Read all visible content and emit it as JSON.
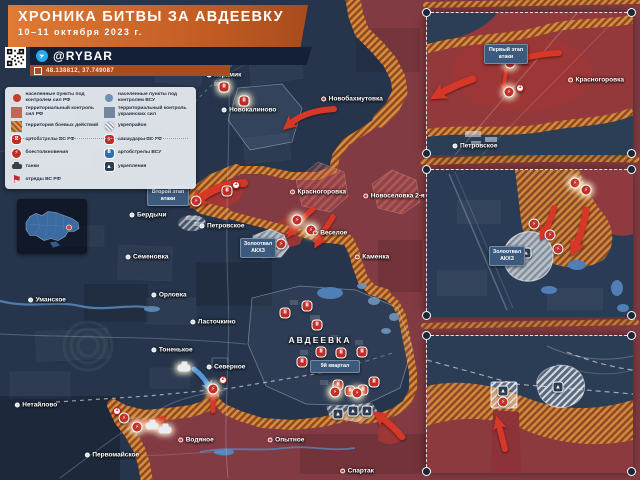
{
  "header": {
    "title": "ХРОНИКА БИТВЫ ЗА АВДЕЕВКУ",
    "date": "10–11 октября 2023 г."
  },
  "brand": {
    "handle": "@RYBAR",
    "coordinates": "48.138812, 37.749087",
    "telegram_icon": "➤"
  },
  "colors": {
    "header_orange": "#d3641f",
    "bar_navy": "#121e36",
    "map_navy": "#26354c",
    "map_red": "#833b43",
    "battle_orange": "#d98a3c",
    "accent_red": "#c03026",
    "accent_blue": "#2e6fae"
  },
  "legend": {
    "left": [
      {
        "type": "dot-rf",
        "glyph": "",
        "label": "населенные пункты под контролем сил РФ"
      },
      {
        "type": "hex-rf",
        "glyph": "",
        "label": "территориальный контроль сил РФ"
      },
      {
        "type": "hex-battle",
        "glyph": "",
        "label": "территория боевых действий"
      },
      {
        "type": "shell-rf",
        "glyph": "Ⅱ",
        "label": "артобстрелы ВС РФ"
      },
      {
        "type": "clash",
        "glyph": "⚡",
        "label": "боестолкновения"
      },
      {
        "type": "tank",
        "glyph": "",
        "label": "танки"
      },
      {
        "type": "flag-rf",
        "glyph": "⚑",
        "label": "отряды ВС РФ"
      }
    ],
    "right": [
      {
        "type": "dot-ua",
        "glyph": "",
        "label": "населенные пункты под контролем ВСУ"
      },
      {
        "type": "hex-ua",
        "glyph": "",
        "label": "территориальный контроль украинских сил"
      },
      {
        "type": "hex-fortarea",
        "glyph": "",
        "label": "укрепрайон"
      },
      {
        "type": "air-rf",
        "glyph": "✈",
        "label": "авиаудары ВС РФ"
      },
      {
        "type": "shell-ua",
        "glyph": "Ⅱ",
        "label": "артобстрелы ВСУ"
      },
      {
        "type": "fort",
        "glyph": "▲",
        "label": "укрепления"
      }
    ]
  },
  "map": {
    "towns": [
      {
        "label": "Керамик",
        "x": 224,
        "y": 75,
        "control": "ua",
        "size": ""
      },
      {
        "label": "Новокалиново",
        "x": 249,
        "y": 110,
        "control": "ua",
        "size": ""
      },
      {
        "label": "Новобахмутовка",
        "x": 352,
        "y": 99,
        "control": "rf",
        "size": ""
      },
      {
        "label": "Красногоровка",
        "x": 318,
        "y": 192,
        "control": "rf",
        "size": ""
      },
      {
        "label": "Новоселовка 2-я",
        "x": 394,
        "y": 196,
        "control": "rf",
        "size": ""
      },
      {
        "label": "Бердычи",
        "x": 148,
        "y": 215,
        "control": "ua",
        "size": ""
      },
      {
        "label": "Петровское",
        "x": 222,
        "y": 226,
        "control": "ua",
        "size": ""
      },
      {
        "label": "Веселое",
        "x": 330,
        "y": 233,
        "control": "rf",
        "size": ""
      },
      {
        "label": "Каменка",
        "x": 372,
        "y": 257,
        "control": "rf",
        "size": ""
      },
      {
        "label": "Семеновка",
        "x": 147,
        "y": 257,
        "control": "ua",
        "size": ""
      },
      {
        "label": "Орловка",
        "x": 169,
        "y": 295,
        "control": "ua",
        "size": ""
      },
      {
        "label": "Ласточкино",
        "x": 213,
        "y": 322,
        "control": "ua",
        "size": ""
      },
      {
        "label": "Уманское",
        "x": 47,
        "y": 300,
        "control": "ua",
        "size": ""
      },
      {
        "label": "Тоненькое",
        "x": 172,
        "y": 350,
        "control": "ua",
        "size": ""
      },
      {
        "label": "Северное",
        "x": 226,
        "y": 367,
        "control": "ua",
        "size": ""
      },
      {
        "label": "АВДЕЕВКА",
        "x": 320,
        "y": 340,
        "control": "ua",
        "size": "big"
      },
      {
        "label": "Нетайлово",
        "x": 36,
        "y": 405,
        "control": "ua",
        "size": ""
      },
      {
        "label": "Водяное",
        "x": 196,
        "y": 440,
        "control": "rf",
        "size": ""
      },
      {
        "label": "Опытное",
        "x": 286,
        "y": 440,
        "control": "rf",
        "size": ""
      },
      {
        "label": "Первомайское",
        "x": 112,
        "y": 455,
        "control": "ua",
        "size": ""
      },
      {
        "label": "Спартак",
        "x": 357,
        "y": 471,
        "control": "rf",
        "size": ""
      },
      {
        "label": "Красногоровка",
        "x": 596,
        "y": 80,
        "control": "rf",
        "size": ""
      },
      {
        "label": "Петровское",
        "x": 475,
        "y": 146,
        "control": "ua",
        "size": ""
      }
    ],
    "badges": [
      {
        "label": "Второй этап атаки",
        "x": 147,
        "y": 186,
        "w": 36
      },
      {
        "label": "Золоотвал АКХЗ",
        "x": 240,
        "y": 238,
        "w": 30
      },
      {
        "label": "9й квартал",
        "x": 310,
        "y": 360,
        "w": 44
      },
      {
        "label": "Первый этап атаки",
        "x": 484,
        "y": 44,
        "w": 38
      },
      {
        "label": "Золоотвал АКХЗ",
        "x": 489,
        "y": 246,
        "w": 30
      }
    ],
    "icons": [
      {
        "name": "shelling-icon",
        "type": "shell-rf",
        "glyph": "Ⅱ",
        "x": 224,
        "y": 87,
        "fx": "glow"
      },
      {
        "name": "shelling-icon",
        "type": "shell-rf",
        "glyph": "Ⅱ",
        "x": 244,
        "y": 101,
        "fx": "glow"
      },
      {
        "name": "clash-icon",
        "type": "clash",
        "glyph": "⚡",
        "x": 196,
        "y": 201,
        "fx": ""
      },
      {
        "name": "number-marker",
        "type": "num",
        "glyph": "1",
        "x": 236,
        "y": 185,
        "fx": ""
      },
      {
        "name": "shelling-icon",
        "type": "shell-rf",
        "glyph": "Ⅱ",
        "x": 227,
        "y": 191,
        "fx": ""
      },
      {
        "name": "clash-icon",
        "type": "clash",
        "glyph": "⚡",
        "x": 297,
        "y": 220,
        "fx": "glow"
      },
      {
        "name": "clash-icon",
        "type": "clash",
        "glyph": "⚡",
        "x": 311,
        "y": 230,
        "fx": "glow"
      },
      {
        "name": "fortification-icon",
        "type": "fort",
        "glyph": "▲",
        "x": 258,
        "y": 247,
        "fx": ""
      },
      {
        "name": "clash-icon",
        "type": "clash",
        "glyph": "⚡",
        "x": 281,
        "y": 244,
        "fx": ""
      },
      {
        "name": "shelling-icon",
        "type": "shell-rf",
        "glyph": "Ⅱ",
        "x": 285,
        "y": 313,
        "fx": ""
      },
      {
        "name": "shelling-icon",
        "type": "shell-rf",
        "glyph": "Ⅱ",
        "x": 307,
        "y": 306,
        "fx": ""
      },
      {
        "name": "shelling-icon",
        "type": "shell-rf",
        "glyph": "Ⅱ",
        "x": 317,
        "y": 325,
        "fx": ""
      },
      {
        "name": "shelling-icon",
        "type": "shell-rf",
        "glyph": "Ⅱ",
        "x": 302,
        "y": 362,
        "fx": ""
      },
      {
        "name": "shelling-icon",
        "type": "shell-rf",
        "glyph": "Ⅱ",
        "x": 321,
        "y": 352,
        "fx": ""
      },
      {
        "name": "shelling-icon",
        "type": "shell-rf",
        "glyph": "Ⅱ",
        "x": 341,
        "y": 353,
        "fx": ""
      },
      {
        "name": "shelling-icon",
        "type": "shell-rf",
        "glyph": "Ⅱ",
        "x": 362,
        "y": 352,
        "fx": ""
      },
      {
        "name": "shelling-icon",
        "type": "shell-rf",
        "glyph": "Ⅱ",
        "x": 338,
        "y": 385,
        "fx": ""
      },
      {
        "name": "shelling-icon",
        "type": "shell-rf",
        "glyph": "Ⅱ",
        "x": 350,
        "y": 391,
        "fx": ""
      },
      {
        "name": "shelling-icon",
        "type": "shell-rf",
        "glyph": "Ⅱ",
        "x": 363,
        "y": 390,
        "fx": ""
      },
      {
        "name": "shelling-icon",
        "type": "shell-rf",
        "glyph": "Ⅱ",
        "x": 374,
        "y": 382,
        "fx": ""
      },
      {
        "name": "fortification-icon",
        "type": "fort",
        "glyph": "▲",
        "x": 338,
        "y": 414,
        "fx": ""
      },
      {
        "name": "fortification-icon",
        "type": "fort",
        "glyph": "▲",
        "x": 353,
        "y": 411,
        "fx": ""
      },
      {
        "name": "fortification-icon",
        "type": "fort",
        "glyph": "▲",
        "x": 367,
        "y": 411,
        "fx": ""
      },
      {
        "name": "tank-icon",
        "type": "tank",
        "glyph": "",
        "x": 184,
        "y": 368,
        "fx": "glow"
      },
      {
        "name": "number-marker",
        "type": "num",
        "glyph": "2",
        "x": 223,
        "y": 380,
        "fx": ""
      },
      {
        "name": "clash-icon",
        "type": "clash",
        "glyph": "⚡",
        "x": 213,
        "y": 389,
        "fx": "glow"
      },
      {
        "name": "number-marker",
        "type": "num",
        "glyph": "1",
        "x": 117,
        "y": 411,
        "fx": ""
      },
      {
        "name": "clash-icon",
        "type": "clash",
        "glyph": "⚡",
        "x": 124,
        "y": 418,
        "fx": ""
      },
      {
        "name": "clash-icon",
        "type": "clash",
        "glyph": "⚡",
        "x": 137,
        "y": 427,
        "fx": "glow"
      },
      {
        "name": "tank-icon",
        "type": "tank",
        "glyph": "",
        "x": 152,
        "y": 426,
        "fx": "glow"
      },
      {
        "name": "tank-icon",
        "type": "tank",
        "glyph": "",
        "x": 165,
        "y": 430,
        "fx": "glow"
      },
      {
        "name": "clash-icon",
        "type": "clash",
        "glyph": "⚡",
        "x": 335,
        "y": 392,
        "fx": "glow"
      },
      {
        "name": "clash-icon",
        "type": "clash",
        "glyph": "⚡",
        "x": 357,
        "y": 393,
        "fx": "glow"
      },
      {
        "name": "clash-icon",
        "type": "clash",
        "glyph": "⚡",
        "x": 510,
        "y": 63,
        "fx": "glow"
      },
      {
        "name": "clash-icon",
        "type": "clash",
        "glyph": "⚡",
        "x": 509,
        "y": 92,
        "fx": "glow"
      },
      {
        "name": "number-marker",
        "type": "num",
        "glyph": "1",
        "x": 520,
        "y": 88,
        "fx": ""
      },
      {
        "name": "clash-icon",
        "type": "clash",
        "glyph": "⚡",
        "x": 534,
        "y": 224,
        "fx": ""
      },
      {
        "name": "clash-icon",
        "type": "clash",
        "glyph": "⚡",
        "x": 550,
        "y": 235,
        "fx": ""
      },
      {
        "name": "clash-icon",
        "type": "clash",
        "glyph": "⚡",
        "x": 558,
        "y": 249,
        "fx": ""
      },
      {
        "name": "clash-icon",
        "type": "clash",
        "glyph": "⚡",
        "x": 575,
        "y": 183,
        "fx": "glow"
      },
      {
        "name": "clash-icon",
        "type": "clash",
        "glyph": "⚡",
        "x": 586,
        "y": 190,
        "fx": "glow"
      },
      {
        "name": "fortification-icon",
        "type": "fort",
        "glyph": "▲",
        "x": 526,
        "y": 253,
        "fx": ""
      },
      {
        "name": "fortification-icon",
        "type": "fort",
        "glyph": "▲",
        "x": 558,
        "y": 387,
        "fx": ""
      },
      {
        "name": "fortification-icon",
        "type": "fort",
        "glyph": "▲",
        "x": 503,
        "y": 391,
        "fx": ""
      },
      {
        "name": "clash-icon",
        "type": "clash",
        "glyph": "⚡",
        "x": 503,
        "y": 402,
        "fx": ""
      }
    ]
  },
  "insets": [
    {
      "name": "inset-first-stage"
    },
    {
      "name": "inset-zolootval"
    },
    {
      "name": "inset-south-front"
    }
  ]
}
